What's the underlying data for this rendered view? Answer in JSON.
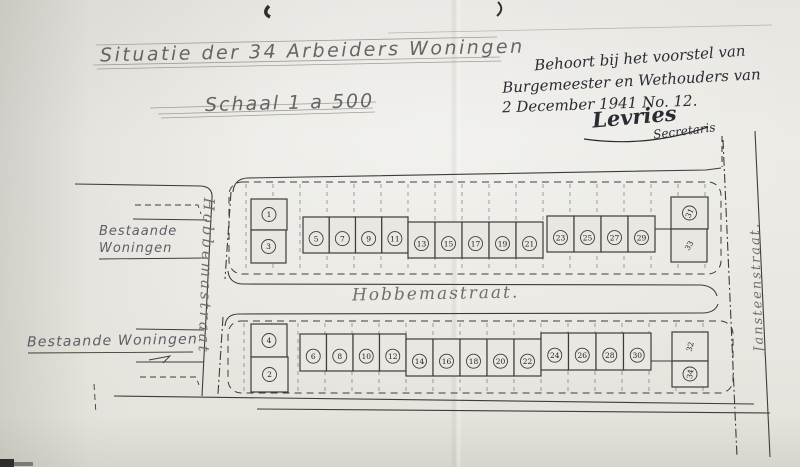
{
  "document": {
    "title": "Situatie der 34 Arbeiders Woningen",
    "scale_label": "Schaal 1 a 500",
    "approval_note": {
      "line1": "Behoort bij het voorstel van",
      "line2": "Burgemeester en Wethouders van",
      "line3": "2 December 1941 No. 12.",
      "signature": "Levries",
      "signature_title": "Secretaris"
    }
  },
  "streets": {
    "hobbemastraat_main": "Hobbemastraat.",
    "hobbemastraat_side": "Hobbemastraat",
    "jansteenstraat": "Jansteenstraat."
  },
  "labels": {
    "existing_upper_line1": "Bestaande",
    "existing_upper_line2": "Woningen",
    "existing_lower": "Bestaande Woningen"
  },
  "houses": {
    "upper_block": {
      "left_stack": [
        "1",
        "3"
      ],
      "row": [
        "5",
        "7",
        "9",
        "11",
        "13",
        "15",
        "17",
        "19",
        "21",
        "23",
        "25",
        "27",
        "29"
      ],
      "right_stack": [
        "31",
        "33"
      ]
    },
    "lower_block": {
      "left_stack": [
        "4",
        "2"
      ],
      "row": [
        "6",
        "8",
        "10",
        "12",
        "14",
        "16",
        "18",
        "20",
        "22",
        "24",
        "26",
        "28",
        "30"
      ],
      "right_stack": [
        "32",
        "34"
      ]
    }
  },
  "colors": {
    "ink": "#2b2b33",
    "drawing_line": "#3d3d3d",
    "pencil_text": "#4f4f4f",
    "paper": "#e9e7e2"
  }
}
